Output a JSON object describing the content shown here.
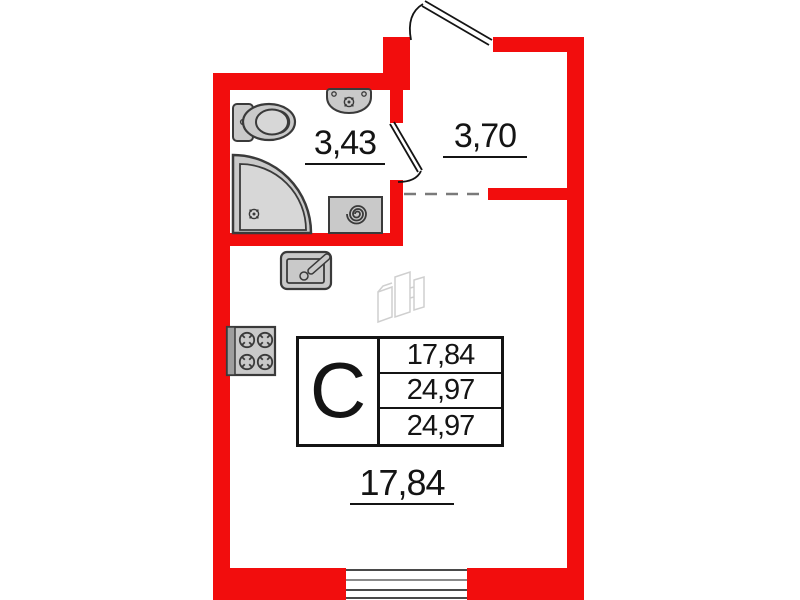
{
  "plan_type": "apartment-floor-plan",
  "areas": {
    "bathroom": "3,43",
    "hallway": "3,70",
    "room": "17,84"
  },
  "info_table": {
    "unit_type": "С",
    "rows": [
      "17,84",
      "24,97",
      "24,97"
    ]
  },
  "fixtures": [
    "toilet",
    "washbasin",
    "corner-shower",
    "washing-machine",
    "kitchen-sink",
    "stove",
    "entrance-door",
    "bathroom-door",
    "window"
  ],
  "colors": {
    "wall": "#f20d0d",
    "fixture_fill": "#c9c9c9",
    "fixture_fill_light": "#d7d7d7",
    "fixture_stroke": "#3a3a3a",
    "line": "#141414",
    "dashed": "#7a7a7a",
    "watermark": "#cfcfcf",
    "text": "#141414"
  }
}
